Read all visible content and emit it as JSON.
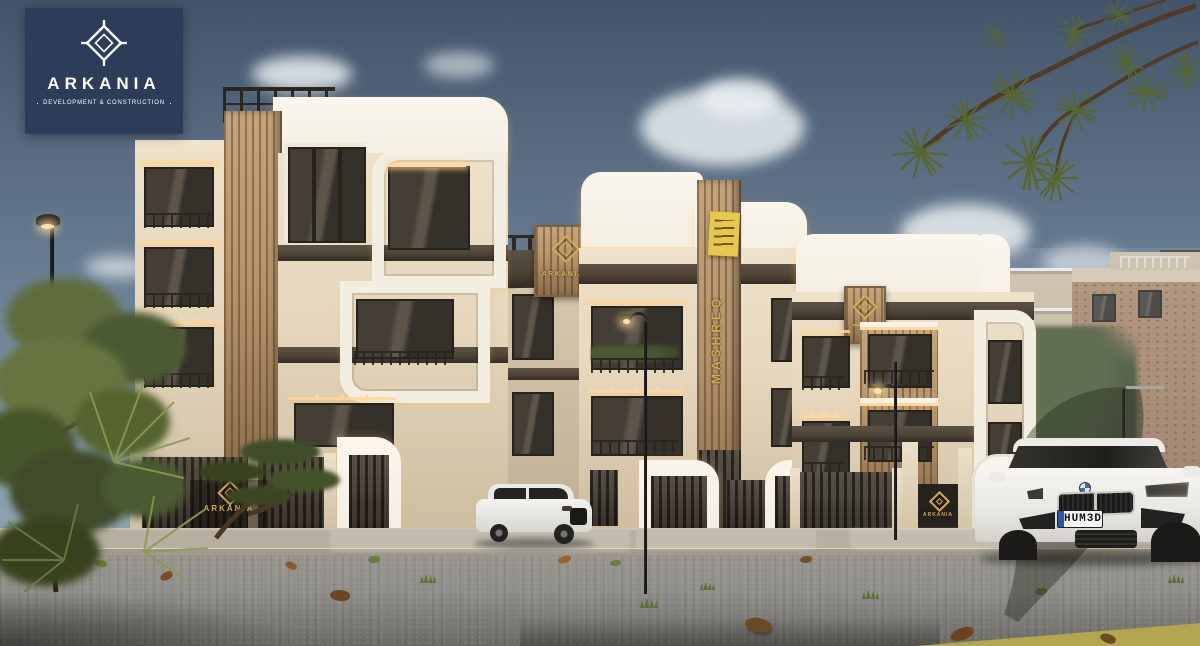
{
  "branding": {
    "logo_title": "ARKANIA",
    "logo_subtitle": "DEVELOPMENT & CONSTRUCTION"
  },
  "signs": {
    "bridge_plaque": "ARKANIA",
    "tower_vertical": "MASHREQ",
    "gate_left": "ARKANIA",
    "gate_right": "ARKANIA"
  },
  "vehicles": {
    "sedan_plate": "HUM3D"
  },
  "colors": {
    "sky_top": "#43546a",
    "sky_mid": "#6e8398",
    "sky_low": "#9fb2bd",
    "cloud": "#e9eef1",
    "navy": "#2d3c58",
    "white_frame": "#f3eee2",
    "cream": "#e5d6bc",
    "cream_dark": "#cdbb9e",
    "bronze": "#4f4537",
    "bronze_dark": "#322c25",
    "wood": "#b3926a",
    "wood_dark": "#8a6c4a",
    "glass": "#34302a",
    "warm": "#ffd9a2",
    "gold": "#d2ab51",
    "banner_yellow": "#e6c84e",
    "brick": "#b78f6f",
    "road": "#8f8e8a",
    "sidewalk": "#b7afa2",
    "curb_yellow": "#b2a74e",
    "green": "#5d6c3d",
    "green_dark": "#3f4b2b"
  }
}
